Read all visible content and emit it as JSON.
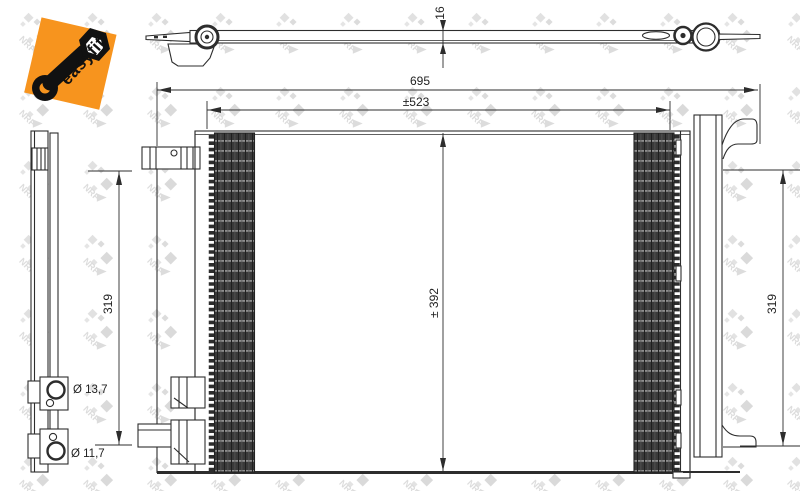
{
  "logo": {
    "text": "easyfit",
    "accent_orange": "#F7941E"
  },
  "watermark": {
    "brand": "NRF",
    "center_line1": "POLOVNI",
    "center_line2": "AUTOMOBILI"
  },
  "dimensions": {
    "thickness": "16",
    "overall_width": "695",
    "core_width": "±523",
    "core_height": "± 392",
    "left_height": "319",
    "right_height": "319",
    "port_top_diameter": "Ø 13,7",
    "port_bottom_diameter": "Ø 11,7"
  },
  "colors": {
    "line": "#2d2d2d",
    "fin_dark": "#3a3a3a",
    "watermark_gray": "#dcdcdc"
  }
}
